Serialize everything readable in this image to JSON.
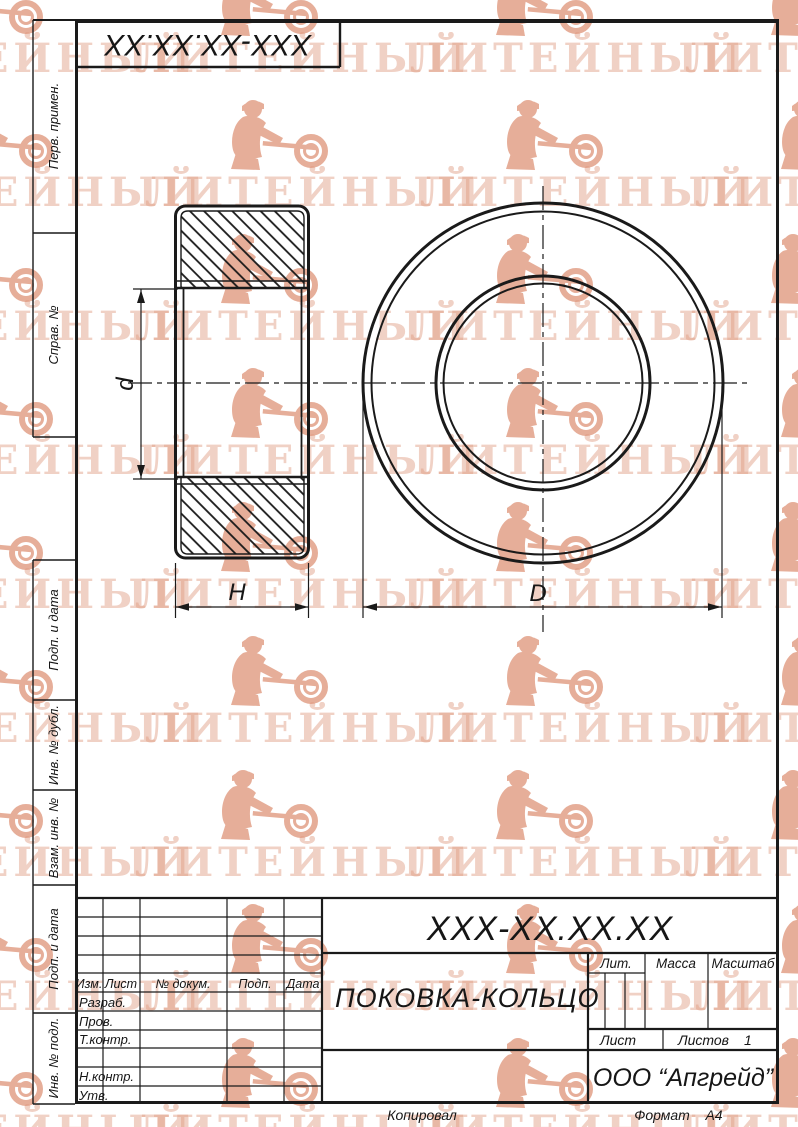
{
  "watermark": {
    "text": "ЛИТЕЙНЫЙ",
    "color": "#e09a80"
  },
  "left_column": {
    "labels": [
      "Перв. примен.",
      "Справ. №",
      "Подп. и дата",
      "Инв. № дубл.",
      "Взам. инв. №",
      "Подп. и дата",
      "Инв. № подл."
    ]
  },
  "drawing": {
    "dims": {
      "inner_diameter": "d",
      "height": "H",
      "outer_diameter": "D"
    }
  },
  "title_block": {
    "designation": "XXX-XX.XX.XX",
    "part_name": "ПОКОВКА-КОЛЬЦО",
    "company": "ООО “Апгрейд”",
    "rev_headers": [
      "Изм.",
      "Лист",
      "№ докум.",
      "Подп.",
      "Дата"
    ],
    "sign_rows": [
      "Разраб.",
      "Пров.",
      "Т.контр.",
      "Н.контр.",
      "Утв."
    ],
    "lit_label": "Лит.",
    "mass_label": "Масса",
    "scale_label": "Масштаб",
    "sheet_label": "Лист",
    "sheets_label": "Листов",
    "sheets_value": "1"
  },
  "footer": {
    "copied_label": "Копировал",
    "format_label": "Формат",
    "format_value": "A4"
  }
}
